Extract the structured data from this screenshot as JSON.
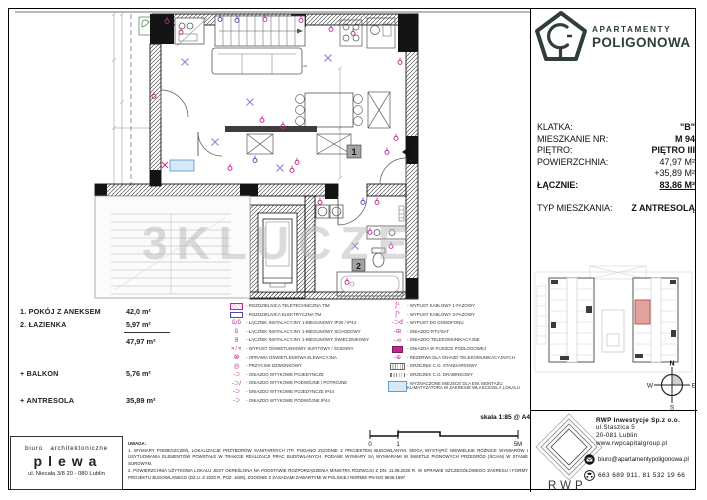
{
  "watermark": "3KLUCZE",
  "logo": {
    "name1": "APARTAMENTY",
    "name2": "POLIGONOWA"
  },
  "info": {
    "rows": [
      {
        "label": "KLATKA:",
        "value": "\"B\""
      },
      {
        "label": "MIESZKANIE NR:",
        "value": "M  94"
      },
      {
        "label": "PIĘTRO:",
        "value": "PIĘTRO III"
      },
      {
        "label": "POWIERZCHNIA:",
        "value": "47,97 M²",
        "cls": "plain"
      },
      {
        "label": "",
        "value": "+35,89 M²",
        "cls": "plain"
      },
      {
        "label": "ŁĄCZNIE:",
        "value": "83,86 M²",
        "cls": "lead underline"
      },
      {
        "label": "TYP MIESZKANIA:",
        "value": "Z ANTRESOLĄ",
        "cls": "gap"
      }
    ]
  },
  "rooms": {
    "items": [
      {
        "name": "1. POKÓJ Z ANEKSEM",
        "area": "42,0 m²"
      },
      {
        "name": "2. ŁAZIENKA",
        "area": "5,97 m²"
      }
    ],
    "total": "47,97 m²",
    "balkon_label": "+ BALKON",
    "balkon_area": "5,76 m²",
    "antresola_label": "+ ANTRESOLA",
    "antresola_area": "35,89 m²"
  },
  "legend": {
    "left": [
      {
        "icon": "i-dist-tele",
        "label": "ROZDZIELNICA TELETECHNICZNA TIM"
      },
      {
        "icon": "i-dist-elec",
        "label": "ROZDZIELNICA ELEKTRYCZNA TM"
      },
      {
        "icon": "i-switch",
        "label": "ŁĄCZNIK INSTALACYJNY 1-BIEGUNOWY IP20 / IP44"
      },
      {
        "icon": "i-switch-stair",
        "label": "ŁĄCZNIK INSTALACYJNY 1-BIEGUNOWY SCHODOWY"
      },
      {
        "icon": "i-switch-chand",
        "label": "ŁĄCZNIK INSTALACYJNY 1-BIEGUNOWY ŚWIECZNIKOWY"
      },
      {
        "icon": "i-light-out",
        "label": "WYPUST OŚWIETLENIOWY SUFITOWY / ŚCIENNY"
      },
      {
        "icon": "i-facade-light",
        "label": "OPRAWA OŚWIETLENIOWA ELEWACYJNA"
      },
      {
        "icon": "i-doorbell",
        "label": "PRZYCISK DZWONKOWY"
      },
      {
        "icon": "i-socket1",
        "label": "GNIAZDO WTYKOWE POJEDYNCZE"
      },
      {
        "icon": "i-socket23",
        "label": "GNIAZDO WTYKOWE PODWÓJNE / POTRÓJNE"
      },
      {
        "icon": "i-socket1-ip44",
        "label": "GNIAZDO WTYKOWE POJEDYNCZE IP44"
      },
      {
        "icon": "i-socket2-ip44",
        "label": "GNIAZDO WTYKOWE PODWÓJNE IP44"
      }
    ],
    "right": [
      {
        "icon": "i-cable1",
        "label": "WYPUST KABLOWY 1-FAZOWY"
      },
      {
        "icon": "i-cable3",
        "label": "WYPUST KABLOWY 3-FAZOWY"
      },
      {
        "icon": "i-intercom",
        "label": "WYPUST DO DOMOFONU"
      },
      {
        "icon": "i-rtv",
        "label": "GNIAZDO RTV/SAT"
      },
      {
        "icon": "i-telecom",
        "label": "GNIAZDO TELEKOMUNIKACYJNE"
      },
      {
        "icon": "i-floorbox",
        "label": "GNIAZDA W PUSZCE PODŁOGOWEJ"
      },
      {
        "icon": "i-telecom-res",
        "label": "REZERWA DLA GNIAZD TELEKOMUNIKACYJNYCH"
      },
      {
        "icon": "i-rad-std",
        "label": "GRZEJNIK C.O. STANDARDOWY"
      },
      {
        "icon": "i-rad-ladder",
        "label": "GRZEJNIK C.O. DRABINKOWY"
      },
      {
        "icon": "i-ac-spot",
        "label": "WYZNACZONE MIEJSCE DLA EW. MONTAŻU KLIMATYZATORA W ZAKRESIE WŁAŚCICIELA LOKALU"
      }
    ]
  },
  "scale": {
    "label": "skala 1:85 @ A4",
    "ticks": [
      "0",
      "1",
      "5M"
    ]
  },
  "uwagi": {
    "heading": "UWAGA:",
    "line1": "1. WYMIARY POMIESZCZEŃ, LOKALIZACJE PRZYBORÓW SANITARNYCH ITP. PODANO ZGODNIE Z PROJEKTEM BUDOWLANYM. MOGĄ WYSTĄPIĆ NIEWIELKIE RÓŻNICE WYMIARÓW I USYTUOWANIA ELEMENTÓW POWSTAŁE W TRAKCIE REALIZACJI PRAC BUDOWLANYCH. PODANE WYMIARY SĄ WYMIARAMI W ŚWIETLE PIONOWYCH PRZEGRÓD (ŚCIAN) W STANIE SUROWYM.",
    "line2": "2. POWIERZCHNIA UŻYTKOWA LOKALU JEST OKREŚLONA NA PODSTAWIE ROZPORZĄDZENIA MINISTRA ROZWOJU Z DN. 11.09.2020 R. W SPRAWIE SZCZEGÓŁOWEGO ZAKRESU I FORMY PROJEKTU BUDOWLANEGO (DZ.U. Z 2020 R. POZ. 1609), ZGODNIE Z ZASADAMI ZAWARTYMI W POLSKIEJ NORMIE PN-ISO 9836:1997"
  },
  "plewa": {
    "line1": "biuro architektoniczne",
    "name": "plewa",
    "address": "ul. Niecała 3/8  20 - 080 Lublin"
  },
  "rwp": {
    "logo_text": "RWP",
    "company": "RWP Inwestycje Sp.z o.o.",
    "address1": "ul.Staszica 5",
    "address2": "20-081 Lublin",
    "web": "www.rwpcapitalgroup.pl",
    "email": "biuro@apartamentypoligonowa.pl",
    "phones": "663 689 911,   81 532 19 66"
  },
  "compass": {
    "n": "N",
    "e": "E",
    "s": "S",
    "w": "W"
  },
  "plan": {
    "room1_no": "1",
    "room2_no": "2"
  },
  "colors": {
    "accent_green": "#2f3e38",
    "magenta": "#c2268e",
    "blue": "#4646b4",
    "highlight_unit": "#e2a39f",
    "ac_blue": "#d6e9f8"
  }
}
